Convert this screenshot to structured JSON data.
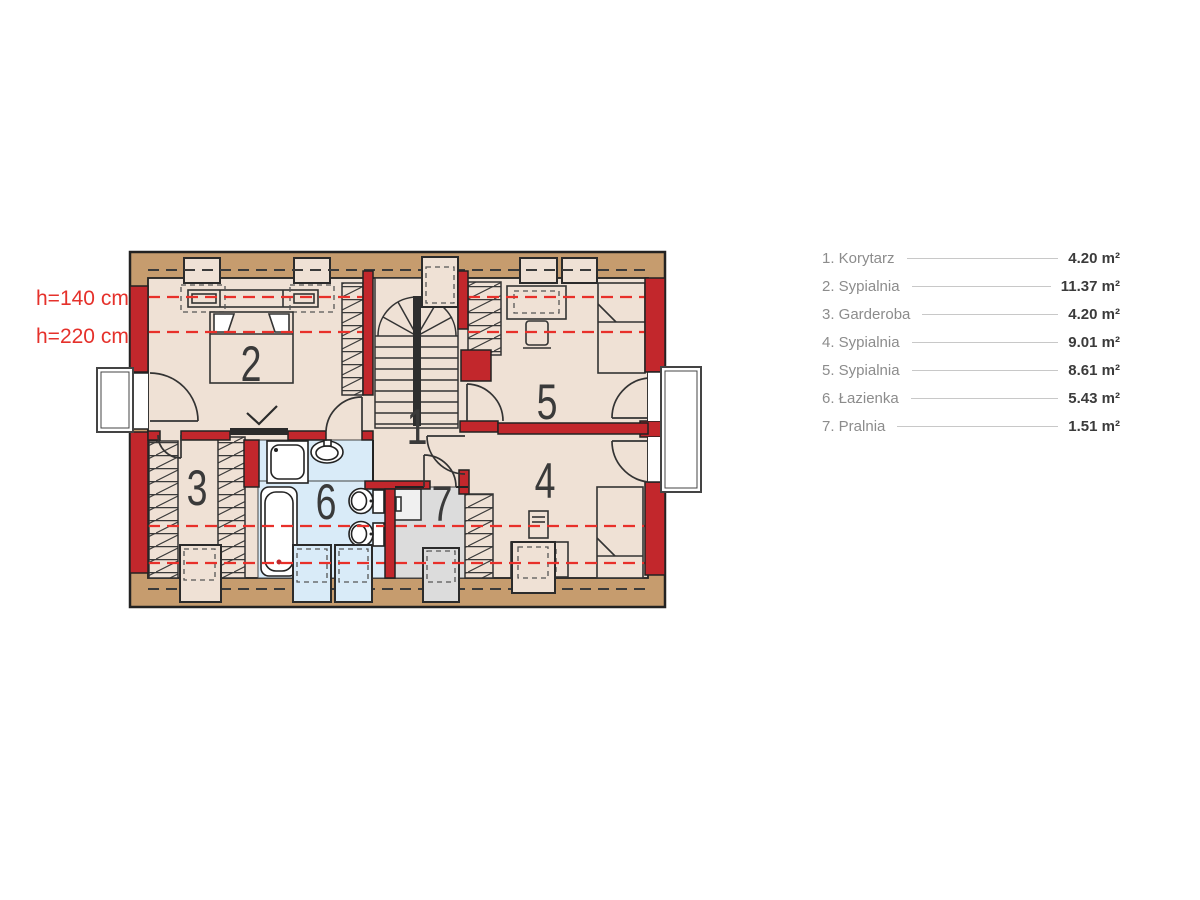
{
  "plan": {
    "height_labels": {
      "upper": "h=140 cm",
      "lower": "h=220 cm"
    },
    "rooms": [
      {
        "number": "1"
      },
      {
        "number": "2"
      },
      {
        "number": "3"
      },
      {
        "number": "4"
      },
      {
        "number": "5"
      },
      {
        "number": "6"
      },
      {
        "number": "7"
      }
    ],
    "colors": {
      "wood_band": "#C69C6E",
      "wall_red": "#C2272C",
      "floor": "#EFE1D5",
      "bathroom_floor": "#D9EBF8",
      "laundry_floor": "#DCDCDC",
      "height_line_red": "#E8302A",
      "label_red": "#E5312B",
      "outline": "#2B2B2B",
      "number_text": "#3A3A3A",
      "legend_label_gray": "#8C8C8C",
      "legend_value_dark": "#3B3B3B"
    }
  },
  "legend": {
    "items": [
      {
        "label": "1. Korytarz",
        "area": "4.20 m²"
      },
      {
        "label": "2. Sypialnia",
        "area": "11.37 m²"
      },
      {
        "label": "3. Garderoba",
        "area": "4.20 m²"
      },
      {
        "label": "4. Sypialnia",
        "area": "9.01 m²"
      },
      {
        "label": "5. Sypialnia",
        "area": "8.61 m²"
      },
      {
        "label": "6. Łazienka",
        "area": "5.43 m²"
      },
      {
        "label": "7. Pralnia",
        "area": "1.51 m²"
      }
    ]
  }
}
